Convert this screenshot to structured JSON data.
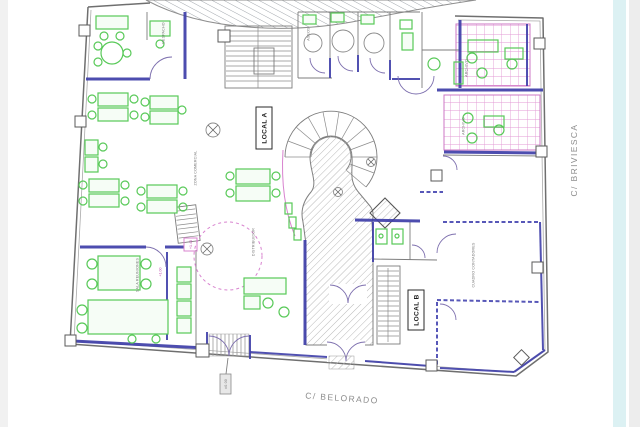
{
  "plan": {
    "title": "planta-comercial-floor-plan",
    "colors": {
      "wall_blue": "#3e3ea8",
      "wall_gray": "#6f6f6f",
      "furniture_green": "#58c958",
      "tile_pink": "#df9bd5",
      "hatch_gray": "#b9b9b9",
      "accent_magenta": "#c856b4",
      "street_text": "#8d8d8d",
      "right_strip_cyan": "#dcf1f3",
      "right_strip_gray": "#ededed",
      "left_strip_gray": "#f1f1f1"
    },
    "labels": {
      "local_a": "LOCAL A",
      "local_b": "LOCAL B",
      "street_right": "C/ BRIVIESCA",
      "street_bottom": "C/ BELORADO",
      "elev_a": "+1.40",
      "elev_b": "+1.00",
      "elev_entry": "±0.00",
      "room_office": "DESPACHO",
      "room_zone": "ZONA COMERCIAL",
      "room_dist": "DISTRIBUIDOR",
      "room_meeting": "SALA REUNIONES",
      "room_counters": "CUADRO CONTADORES",
      "room_archive1": "ARCHIVO",
      "room_archive2": "ARCHIVO",
      "room_wc": "ASEOS"
    }
  }
}
